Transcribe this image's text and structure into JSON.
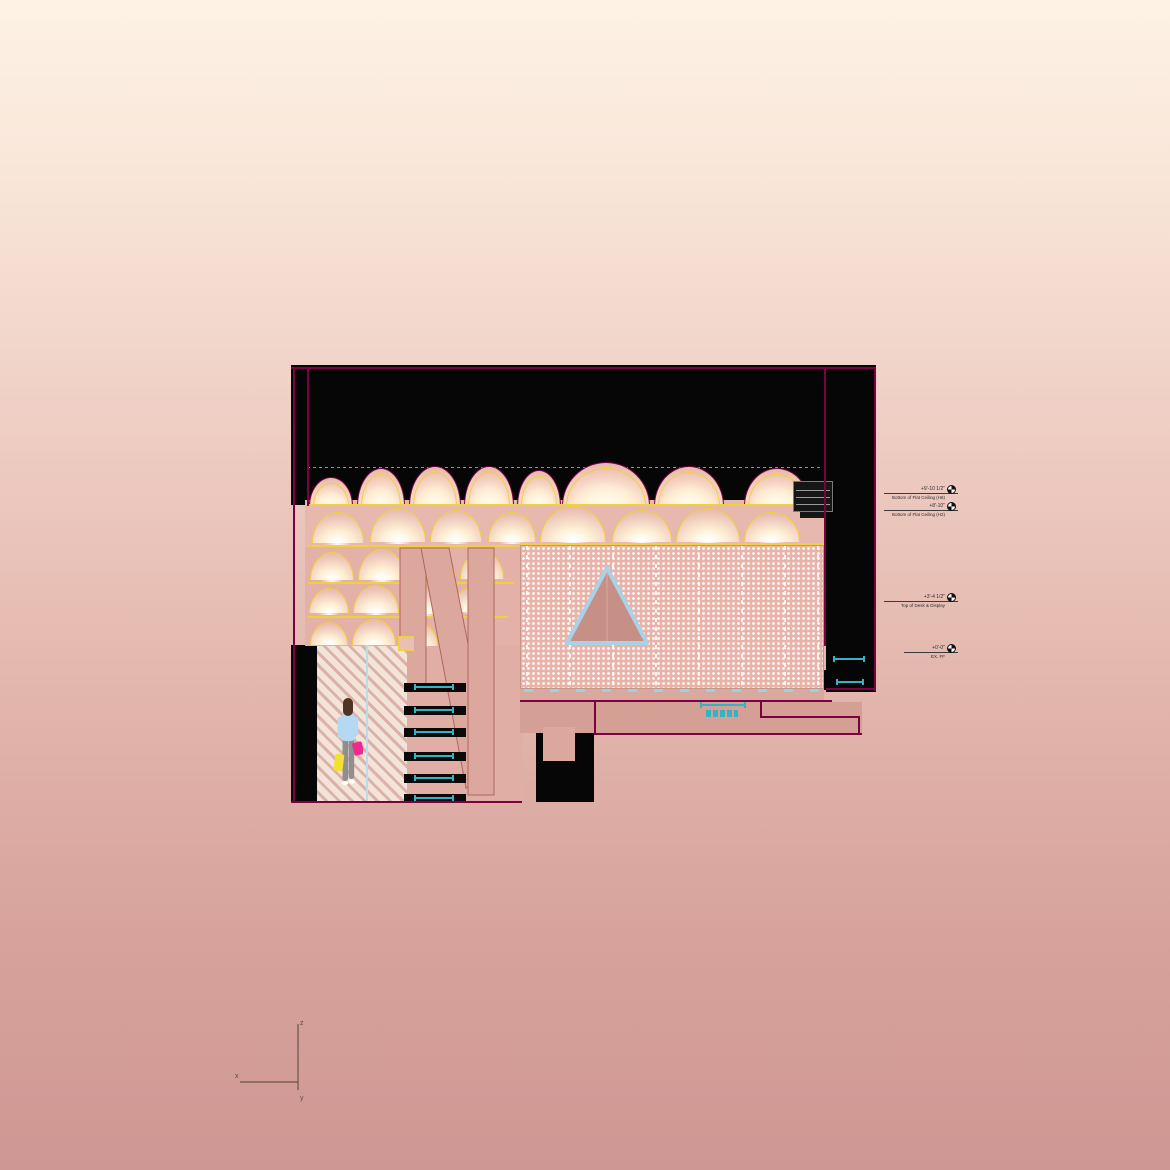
{
  "title": "architectural-section-rendering",
  "colors": {
    "bg_top": "#fdf2e4",
    "bg_bottom": "#cf9793",
    "poche": "#060606",
    "outline": "#7c0141",
    "yellow": "#f0d13a",
    "cyan": "#35b2c4",
    "screen_base": "#e9b3a9",
    "hatch_light": "#f3e4da",
    "hatch_dark": "#dcb2a8",
    "structure_fill": "#dca79d",
    "structure_stroke": "#ae675e",
    "triangle_stroke": "#a9d2e8",
    "triangle_fill": "#c79086",
    "blue_divider": "#b8dcea"
  },
  "person": {
    "hair": "#4e3423",
    "top": "#b5d9f2",
    "pants": "#8f8f90",
    "shoes": "#ffffff",
    "bag_left": "#f2e130",
    "bag_right": "#ee2a8e"
  },
  "annotations": {
    "items": [
      {
        "elevation": "+9'-10 1/2\"",
        "label": "Bottom of Flat Ceiling (H8)",
        "x": 884,
        "y": 493,
        "w": 74
      },
      {
        "elevation": "+8'-10\"",
        "label": "Bottom of Flat Ceiling (H2)",
        "x": 884,
        "y": 510,
        "w": 74
      },
      {
        "elevation": "+3'-4 1/2\"",
        "label": "Top of Desk & Display",
        "x": 884,
        "y": 601,
        "w": 74
      },
      {
        "elevation": "+0'-0\"",
        "label": "EX. FF",
        "x": 904,
        "y": 652,
        "w": 54
      }
    ]
  },
  "axis_indicator": {
    "x_label": "x",
    "y_label": "y",
    "z_label": "z"
  },
  "drawing": {
    "black_rects": [
      [
        291,
        365,
        585,
        140
      ],
      [
        824,
        365,
        52,
        280
      ],
      [
        826,
        645,
        50,
        47
      ],
      [
        291,
        645,
        26,
        158
      ],
      [
        536,
        718,
        58,
        84
      ],
      [
        690,
        700,
        64,
        22
      ],
      [
        822,
        670,
        18,
        20
      ]
    ],
    "interior_rects": [
      {
        "r": [
          305,
          500,
          519,
          47
        ],
        "c": "#e7b8ae"
      },
      {
        "r": [
          305,
          547,
          215,
          99
        ],
        "c": "#e3b1a7"
      },
      {
        "r": [
          405,
          645,
          117,
          158
        ],
        "c": "#e0aea4"
      },
      {
        "r": [
          520,
          688,
          304,
          14
        ],
        "c": "#d9a89e"
      },
      {
        "r": [
          520,
          702,
          342,
          31
        ],
        "c": "#d4a096"
      },
      {
        "r": [
          543,
          727,
          32,
          34
        ],
        "c": "#dca89e"
      }
    ],
    "gray_dashed": [
      307,
      467,
      513,
      1
    ],
    "top_arches": [
      [
        309,
        477,
        42,
        28
      ],
      [
        357,
        468,
        46,
        37
      ],
      [
        409,
        466,
        50,
        39
      ],
      [
        464,
        466,
        48,
        39
      ],
      [
        517,
        470,
        42,
        35
      ],
      [
        562,
        462,
        86,
        43
      ],
      [
        654,
        466,
        68,
        39
      ],
      [
        744,
        468,
        64,
        37
      ]
    ],
    "shelf_arcs": [
      [
        312,
        512,
        50,
        30
      ],
      [
        370,
        508,
        54,
        33
      ],
      [
        430,
        510,
        50,
        31
      ],
      [
        488,
        512,
        46,
        29
      ],
      [
        540,
        506,
        64,
        35
      ],
      [
        612,
        510,
        58,
        31
      ],
      [
        676,
        508,
        62,
        33
      ],
      [
        744,
        512,
        54,
        29
      ],
      [
        310,
        552,
        42,
        27
      ],
      [
        358,
        549,
        46,
        30
      ],
      [
        410,
        552,
        44,
        28
      ],
      [
        460,
        551,
        42,
        27
      ],
      [
        309,
        588,
        38,
        24
      ],
      [
        353,
        585,
        44,
        27
      ],
      [
        402,
        588,
        42,
        25
      ],
      [
        452,
        587,
        38,
        24
      ],
      [
        310,
        622,
        36,
        22
      ],
      [
        352,
        619,
        42,
        25
      ],
      [
        398,
        622,
        38,
        23
      ]
    ],
    "yellow_lines": [
      [
        307,
        504,
        517,
        1.5
      ],
      [
        308,
        545,
        210,
        1.5
      ],
      [
        308,
        582,
        206,
        1.5
      ],
      [
        308,
        616,
        200,
        1.5
      ],
      [
        520,
        543,
        304,
        1.5
      ]
    ],
    "structure_polys": [
      "400,548 426,548 426,690 400,690",
      "421,548 449,548 494,775 466,788",
      "468,548 494,548 494,795 468,795"
    ],
    "screen": {
      "r": [
        520,
        545,
        304,
        144
      ],
      "panel_xs": [
        525,
        568,
        611,
        654,
        697,
        740,
        783,
        816
      ]
    },
    "triangle": {
      "r": [
        560,
        560,
        95,
        90
      ],
      "points": "47,8 87,83 7,83",
      "mid_x": 47
    },
    "screen_bottom_ticks": [
      524,
      689,
      300,
      3
    ],
    "hatch": [
      317,
      645,
      90,
      157
    ],
    "blue_line": [
      366,
      645,
      2,
      157
    ],
    "yellow_square": [
      398,
      636,
      16,
      15
    ],
    "person_box": [
      333,
      695,
      30,
      100
    ],
    "stair_slots": {
      "x": 404,
      "w": 62,
      "h": 9,
      "ys": [
        683,
        706,
        728,
        752,
        774,
        794
      ]
    },
    "cyan_dims": [
      [
        700,
        704,
        46,
        2
      ],
      [
        833,
        658,
        32,
        2
      ],
      [
        836,
        681,
        28,
        2
      ]
    ],
    "cyan_labels": [
      [
        706,
        710,
        32,
        7
      ]
    ],
    "mech_unit": [
      793,
      481,
      40,
      31
    ],
    "magenta_lines": [
      [
        291,
        367,
        585,
        1.5
      ],
      [
        293,
        367,
        1.5,
        436
      ],
      [
        874,
        367,
        1.5,
        324
      ],
      [
        307,
        367,
        1.5,
        139
      ],
      [
        824,
        367,
        1.5,
        279
      ],
      [
        826,
        688,
        50,
        1.5
      ],
      [
        291,
        801,
        231,
        1.5
      ],
      [
        520,
        700,
        312,
        1.5
      ],
      [
        594,
        733,
        268,
        1.5
      ],
      [
        594,
        701,
        1.5,
        33
      ],
      [
        760,
        702,
        1.5,
        15
      ],
      [
        760,
        716,
        100,
        1.5
      ],
      [
        858,
        716,
        1.5,
        18
      ]
    ],
    "axis_box": [
      234,
      1014,
      76,
      90
    ]
  }
}
